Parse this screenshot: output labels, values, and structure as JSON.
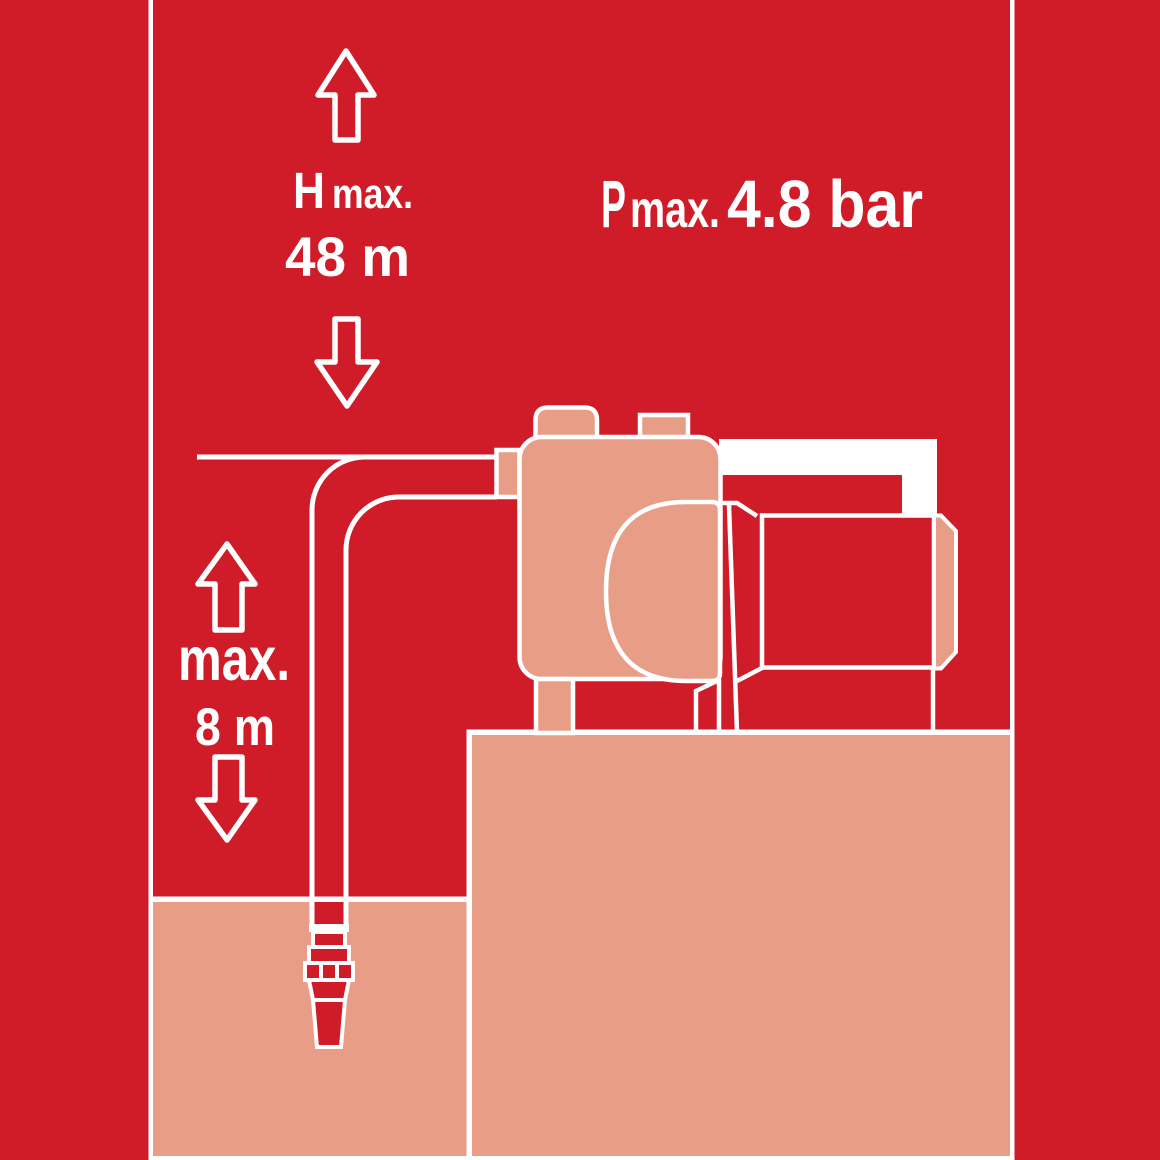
{
  "title": "Garden pump delivery head and suction height diagram",
  "colors": {
    "background_red": "#d01b28",
    "illustration_salmon": "#e89e86",
    "line_white": "#ffffff"
  },
  "delivery_head": {
    "symbol": "H",
    "subscript": "max.",
    "value": "48 m"
  },
  "pressure": {
    "symbol": "P",
    "subscript": "max.",
    "value": "4.8 bar"
  },
  "suction_height": {
    "label": "max.",
    "value": "8 m"
  }
}
